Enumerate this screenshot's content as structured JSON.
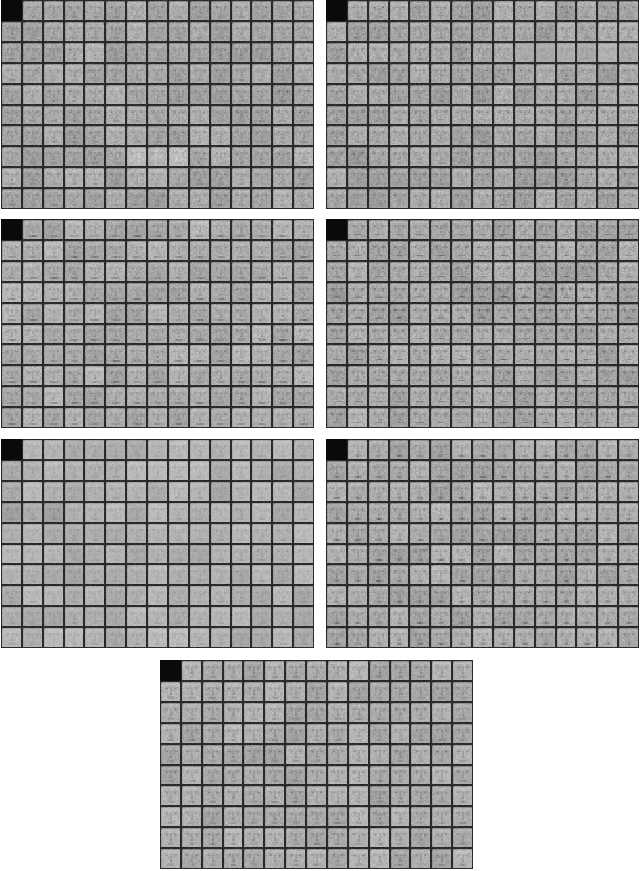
{
  "page": {
    "background": "#ffffff",
    "width": 640,
    "height": 871
  },
  "figure": {
    "kind": "face-sample-montage",
    "panel_count": 7,
    "grid": {
      "rows": 10,
      "cols": 15
    },
    "tile": {
      "black_cell": [
        0,
        0
      ],
      "black_color_luma": 10,
      "border_luma": 34,
      "quantize": 16
    },
    "colors": {
      "page_background": "#ffffff",
      "face_base_gray": "#a8a8a8",
      "feature_dark_gray": "#5a5a5a",
      "grid_line": "#222222",
      "black_square": "#0a0a0a"
    },
    "panels": [
      {
        "name": "panel-1-top-left",
        "left": 1,
        "top": 0,
        "width": 313,
        "height": 209,
        "seed": 101,
        "style": {
          "bright": 168,
          "contrast": 1.0,
          "eye": 44,
          "brow": 26,
          "nose": 22,
          "mouth": 26,
          "smile": 0,
          "mouthW": 0.1,
          "teeth": 0,
          "chinDash": 0,
          "hair": 38,
          "noise": 13,
          "oval": 0
        },
        "anomalies": [
          {
            "rows": [
              7,
              7
            ],
            "cols": [
              6,
              8
            ],
            "mul": {
              "eye": 0.7,
              "mouth": 0.7
            },
            "add": {
              "bright": 10,
              "oval": 16
            }
          },
          {
            "rows": [
              4,
              4
            ],
            "cols": [
              13,
              14
            ],
            "mul": {
              "eye": 1.5,
              "brow": 1.5
            },
            "add": {
              "bright": -8
            }
          }
        ]
      },
      {
        "name": "panel-2-top-right",
        "left": 326,
        "top": 0,
        "width": 313,
        "height": 209,
        "seed": 202,
        "style": {
          "bright": 167,
          "contrast": 1.0,
          "eye": 48,
          "brow": 30,
          "nose": 22,
          "mouth": 30,
          "smile": 0.02,
          "mouthW": 0.1,
          "teeth": 0,
          "chinDash": 0,
          "hair": 40,
          "noise": 14,
          "oval": 0
        },
        "anomalies": [
          {
            "rows": [
              2,
              2
            ],
            "cols": [
              9,
              14
            ],
            "mul": {
              "contrast": 0.55
            },
            "add": {
              "bright": 8
            }
          },
          {
            "rows": [
              6,
              6
            ],
            "cols": [
              14,
              14
            ],
            "mul": {
              "eye": 1.6,
              "mouth": 1.4
            },
            "add": {
              "bright": -6
            }
          },
          {
            "rows": [
              7,
              7
            ],
            "cols": [
              0,
              1
            ],
            "mul": {
              "eye": 1.4,
              "brow": 1.3
            },
            "add": {
              "bright": -8
            }
          }
        ]
      },
      {
        "name": "panel-3-mid-left",
        "left": 1,
        "top": 219,
        "width": 313,
        "height": 209,
        "seed": 303,
        "style": {
          "bright": 173,
          "contrast": 1.0,
          "eye": 40,
          "brow": 26,
          "nose": 26,
          "mouth": 50,
          "smile": 0,
          "mouthW": 0.13,
          "teeth": 20,
          "chinDash": 0,
          "hair": 34,
          "noise": 12,
          "oval": 0
        },
        "anomalies": []
      },
      {
        "name": "panel-4-mid-right",
        "left": 326,
        "top": 219,
        "width": 313,
        "height": 209,
        "seed": 404,
        "style": {
          "bright": 169,
          "contrast": 1.0,
          "eye": 50,
          "brow": 42,
          "nose": 22,
          "mouth": 46,
          "smile": 0.09,
          "mouthW": 0.12,
          "teeth": 16,
          "chinDash": 0,
          "hair": 40,
          "noise": 14,
          "oval": 0
        },
        "anomalies": [
          {
            "rows": [
              3,
              4
            ],
            "cols": [
              0,
              14
            ],
            "mul": {
              "mouth": 1.45,
              "brow": 1.35,
              "smile": 1.6,
              "eye": 1.25
            },
            "add": {
              "bright": -4
            }
          },
          {
            "rows": [
              7,
              7
            ],
            "cols": [
              1,
              4
            ],
            "mul": {
              "mouth": 1.35,
              "smile": 1.4
            },
            "add": {}
          }
        ]
      },
      {
        "name": "panel-5-lower-left",
        "left": 1,
        "top": 439,
        "width": 313,
        "height": 209,
        "seed": 505,
        "style": {
          "bright": 177,
          "contrast": 0.8,
          "eye": 34,
          "brow": 20,
          "nose": 20,
          "mouth": 24,
          "smile": 0,
          "mouthW": 0.1,
          "teeth": 0,
          "chinDash": 0,
          "hair": 28,
          "noise": 10,
          "oval": 0
        },
        "anomalies": [
          {
            "rows": [
              3,
              3
            ],
            "cols": [
              0,
              2
            ],
            "mul": {
              "eye": 1.4,
              "mouth": 1.3
            },
            "add": {
              "bright": -8
            }
          }
        ]
      },
      {
        "name": "panel-6-lower-right",
        "left": 326,
        "top": 439,
        "width": 313,
        "height": 209,
        "seed": 606,
        "style": {
          "bright": 171,
          "contrast": 1.0,
          "eye": 44,
          "brow": 30,
          "nose": 26,
          "mouth": 60,
          "smile": 0,
          "mouthW": 0.085,
          "teeth": 0,
          "chinDash": 18,
          "hair": 36,
          "noise": 12,
          "oval": 0
        },
        "anomalies": [
          {
            "rows": [
              3,
              3
            ],
            "cols": [
              6,
              9
            ],
            "mul": {
              "mouth": 1.4
            },
            "add": {}
          }
        ]
      },
      {
        "name": "panel-7-bottom-center",
        "left": 160,
        "top": 660,
        "width": 313,
        "height": 209,
        "seed": 707,
        "style": {
          "bright": 173,
          "contrast": 1.0,
          "eye": 46,
          "brow": 34,
          "nose": 34,
          "mouth": 34,
          "smile": 0,
          "mouthW": 0.1,
          "teeth": 0,
          "chinDash": 0,
          "hair": 36,
          "noise": 11,
          "oval": 0
        },
        "anomalies": [
          {
            "rows": [
              2,
              2
            ],
            "cols": [
              11,
              12
            ],
            "mul": {
              "eye": 1.5,
              "brow": 1.4
            },
            "add": {
              "bright": -6
            }
          },
          {
            "rows": [
              4,
              4
            ],
            "cols": [
              13,
              13
            ],
            "mul": {
              "eye": 1.5,
              "mouth": 1.3
            },
            "add": {}
          }
        ]
      }
    ]
  }
}
